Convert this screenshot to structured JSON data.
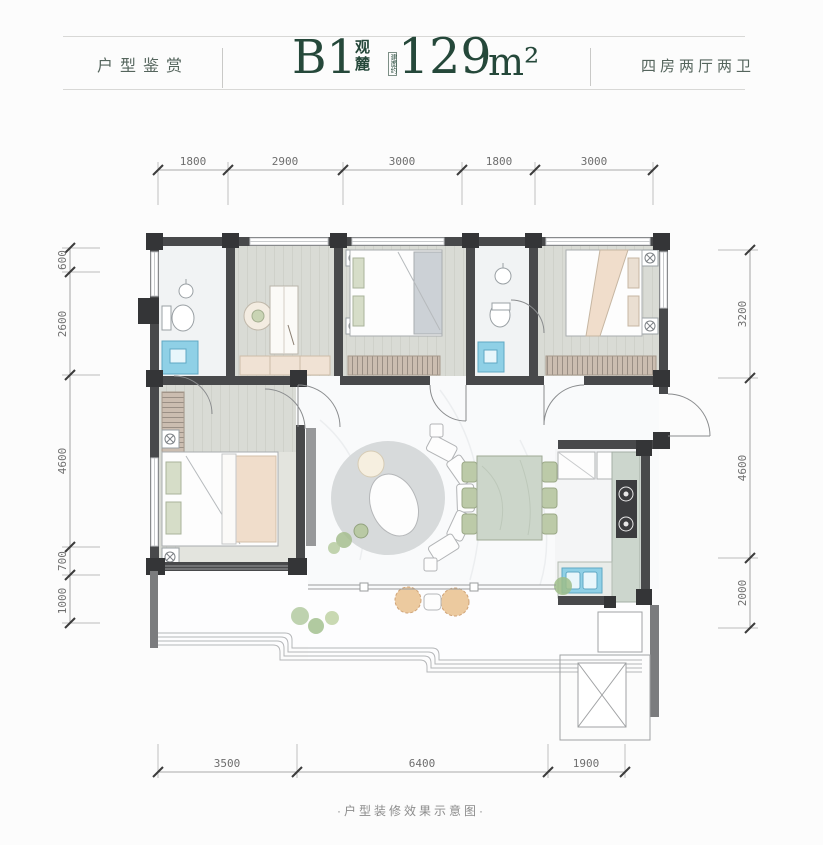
{
  "header": {
    "left_label": "户型鉴赏",
    "unit_code": "B1",
    "unit_name": "观麓",
    "area_prefix": "建面约",
    "area_value": "129",
    "area_unit": "m²",
    "right_label": "四房两厅两卫"
  },
  "dims": {
    "top": [
      "1800",
      "2900",
      "3000",
      "1800",
      "3000"
    ],
    "left": [
      "600",
      "2600",
      "4600",
      "700",
      "1000"
    ],
    "right": [
      "3200",
      "4600",
      "2000"
    ],
    "bottom": [
      "3500",
      "6400",
      "1900"
    ]
  },
  "footer": {
    "caption": "·户型装修效果示意图·"
  },
  "colors": {
    "brand_green": "#25483a",
    "label_green": "#55655d",
    "wall_dark": "#48494b",
    "pillar_dark": "#343537",
    "wall_mid_gray": "#7b7c7e",
    "bedroom_floor": "#d9dbd5",
    "bath_floor": "#f1f3f4",
    "hall_floor": "#f9fafb",
    "counter_green": "#ccd6ca",
    "sink_blue": "#8fd0e6",
    "chair_green": "#bccaa8",
    "accent_beige": "#eeddcd",
    "plant_green": "#a6bd8e",
    "dim_text": "#6e6e6e"
  }
}
